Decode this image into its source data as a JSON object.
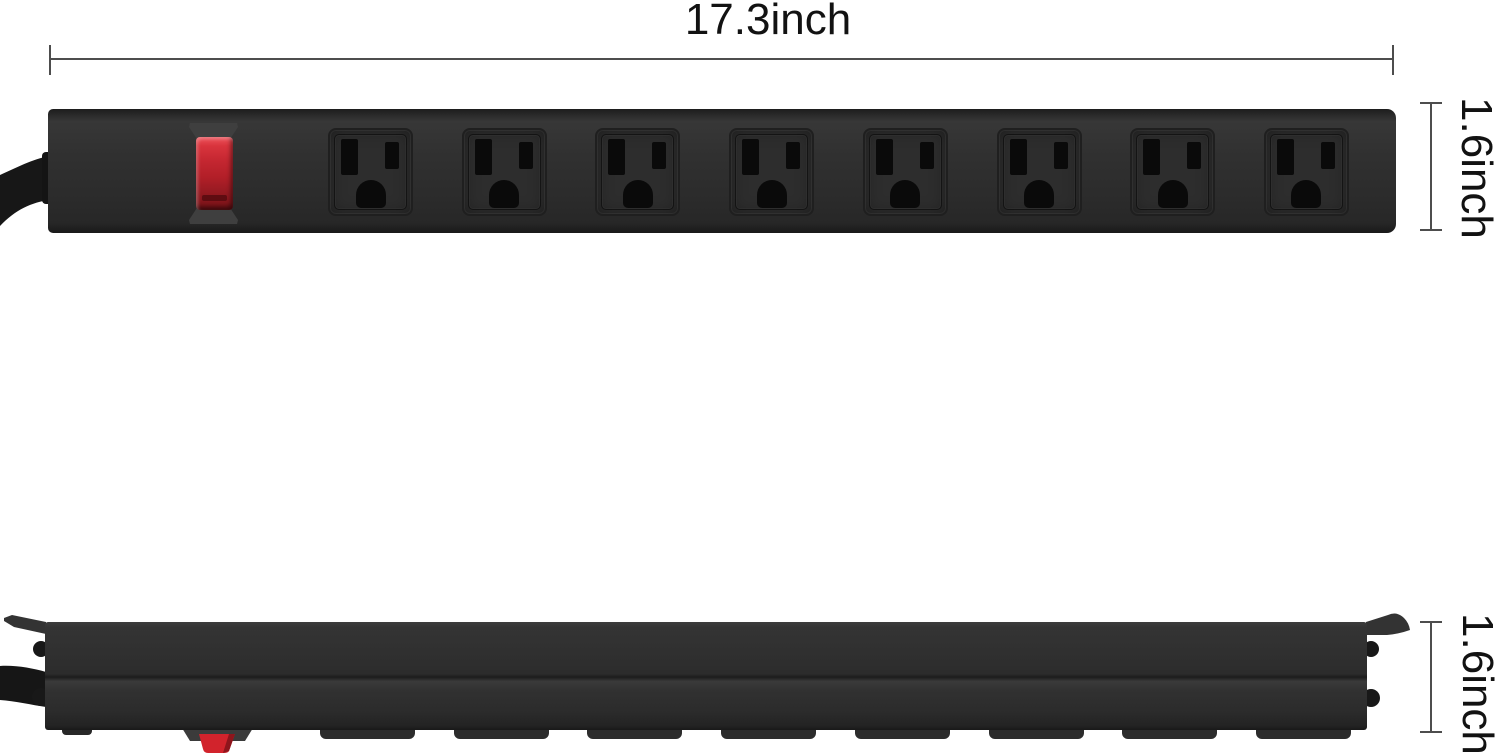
{
  "annotations": {
    "width_label": "17.3inch",
    "front_height_label": "1.6inch",
    "side_height_label": "1.6inch"
  },
  "front_view": {
    "name": "power strip front view",
    "outlet_count": 8,
    "has_power_switch": true
  },
  "side_view": {
    "name": "power strip side profile view",
    "tab_count": 8
  },
  "colors": {
    "body": "#2e2e2e",
    "edge": "#1d1d1d",
    "slot": "#0a0a0a",
    "switch_red": "#c62730",
    "dimension_line": "#4d4d4d",
    "text": "#121212",
    "background": "#ffffff"
  }
}
